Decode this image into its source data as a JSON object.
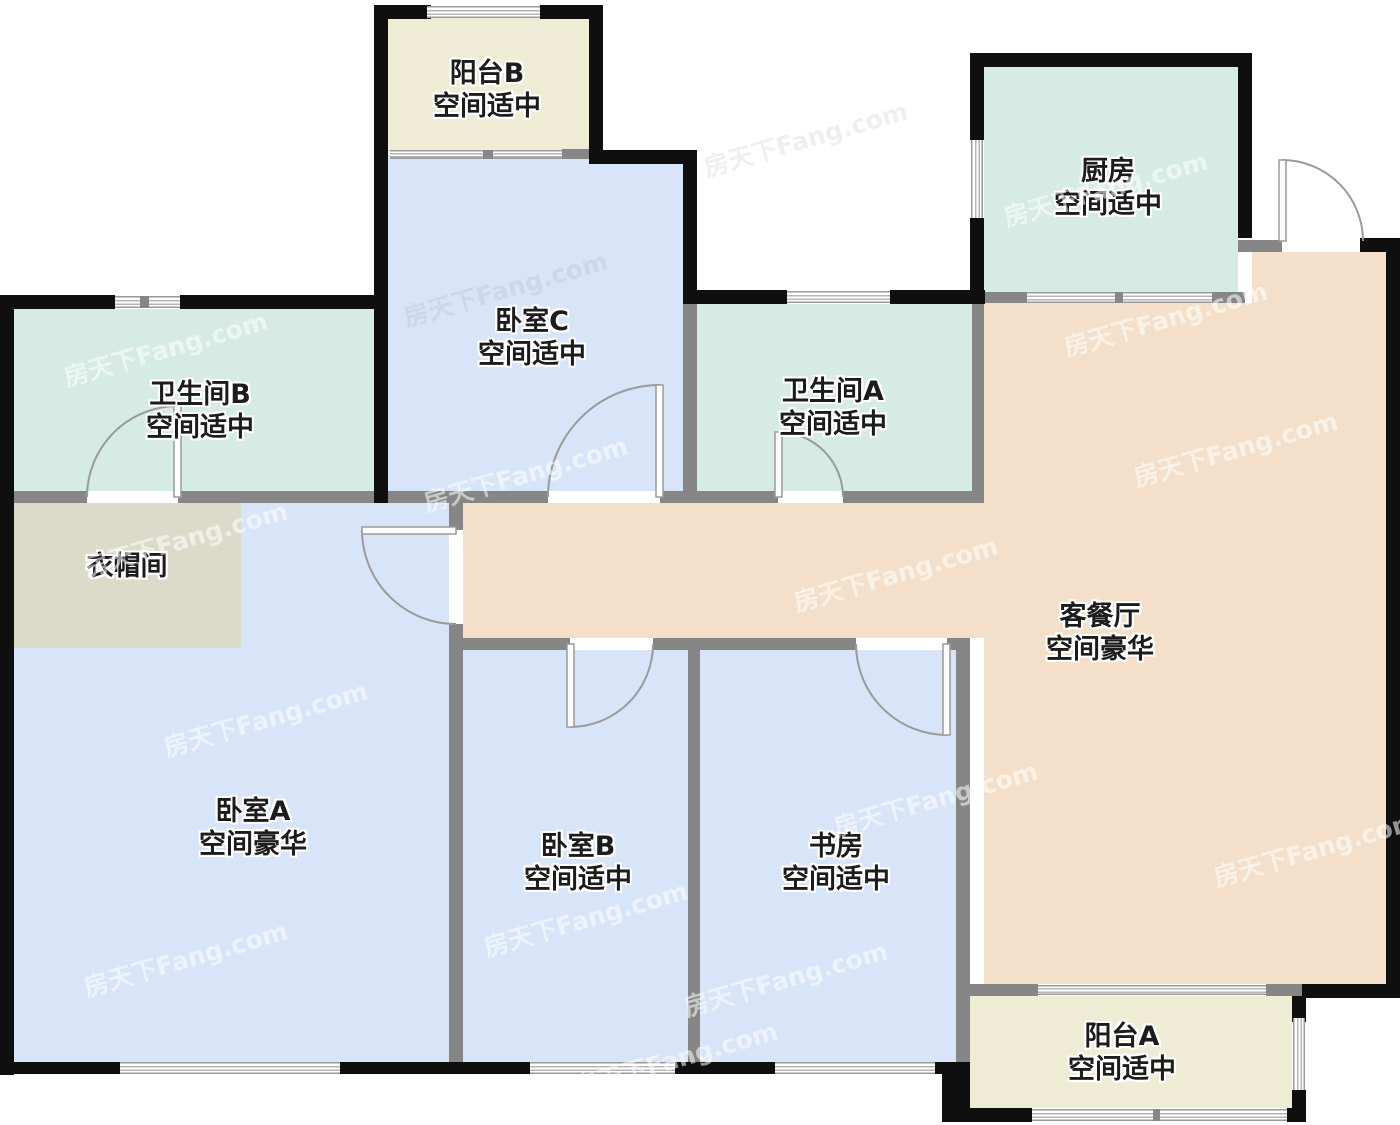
{
  "floorplan": {
    "watermark": "房天下Fang.com",
    "space_moderate": "空间适中",
    "space_luxury": "空间豪华",
    "rooms": [
      {
        "id": "balcony-b",
        "name": "阳台B",
        "desc": "空间适中"
      },
      {
        "id": "kitchen",
        "name": "厨房",
        "desc": "空间适中"
      },
      {
        "id": "bathroom-b",
        "name": "卫生间B",
        "desc": "空间适中"
      },
      {
        "id": "bedroom-c",
        "name": "卧室C",
        "desc": "空间适中"
      },
      {
        "id": "bathroom-a",
        "name": "卫生间A",
        "desc": "空间适中"
      },
      {
        "id": "cloakroom",
        "name": "衣帽间",
        "desc": ""
      },
      {
        "id": "living-dining",
        "name": "客餐厅",
        "desc": "空间豪华"
      },
      {
        "id": "bedroom-a",
        "name": "卧室A",
        "desc": "空间豪华"
      },
      {
        "id": "bedroom-b",
        "name": "卧室B",
        "desc": "空间适中"
      },
      {
        "id": "study",
        "name": "书房",
        "desc": "空间适中"
      },
      {
        "id": "balcony-a",
        "name": "阳台A",
        "desc": "空间适中"
      }
    ],
    "colors": {
      "exterior_wall": "#0f0f0f",
      "interior_wall": "#868686",
      "bedroom_fill": "#d8e4f8",
      "bath_kitchen_fill": "#d6ebe3",
      "living_fill": "#f4e0ca",
      "balcony_fill": "#eeecd5",
      "cloakroom_fill": "#dcdbc9",
      "door_arc": "#9a9a9a",
      "label_text": "#1c1c1c"
    }
  }
}
